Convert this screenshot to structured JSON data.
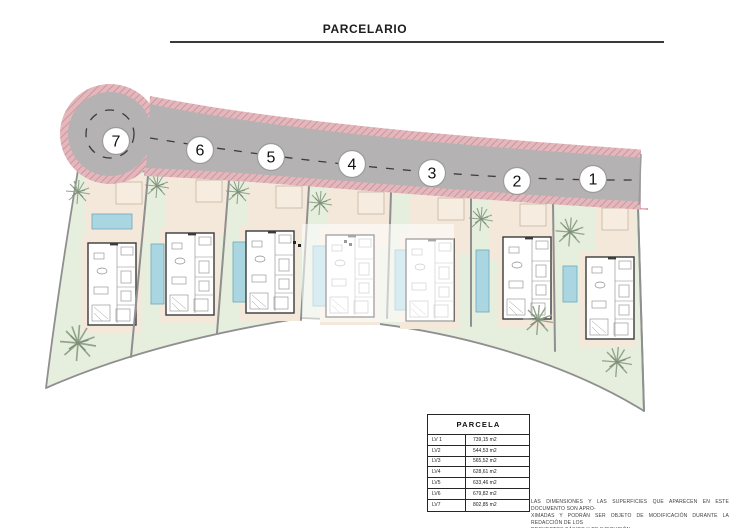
{
  "page": {
    "title": "PARCELARIO"
  },
  "plan": {
    "markers": [
      "7",
      "6",
      "5",
      "4",
      "3",
      "2",
      "1"
    ],
    "colors": {
      "road_gray": "#b5b2b4",
      "road_border_pink": "#e3b7bc",
      "road_border_hatch": "#c58f97",
      "lawn_green": "#e6eedd",
      "terrace_beige": "#f4e8da",
      "pool_blue": "#a9d6e1",
      "boundary_gray": "#8f8f8f"
    }
  },
  "table": {
    "header": "PARCELA",
    "rows": [
      {
        "label": "LV 1",
        "value": "739,15 m2"
      },
      {
        "label": "LV2",
        "value": "544,53 m2"
      },
      {
        "label": "LV3",
        "value": "565,52 m2"
      },
      {
        "label": "LV4",
        "value": "628,61 m2"
      },
      {
        "label": "LV5",
        "value": "633,46 m2"
      },
      {
        "label": "LV6",
        "value": "679,82 m2"
      },
      {
        "label": "LV7",
        "value": "802,85 m2"
      }
    ]
  },
  "disclaimer": {
    "lines": [
      "LAS DIMENSIONES Y LAS SUPERFICIES QUE APARECEN EN ESTE DOCUMENTO SON APRO-",
      "XIMADAS Y PODRÁN SER OBJETO DE MODIFICACIÓN DURANTE LA REDACCIÓN DE LOS",
      "PROYECTOS BÁSICO Y DE EJECUCIÓN"
    ]
  }
}
